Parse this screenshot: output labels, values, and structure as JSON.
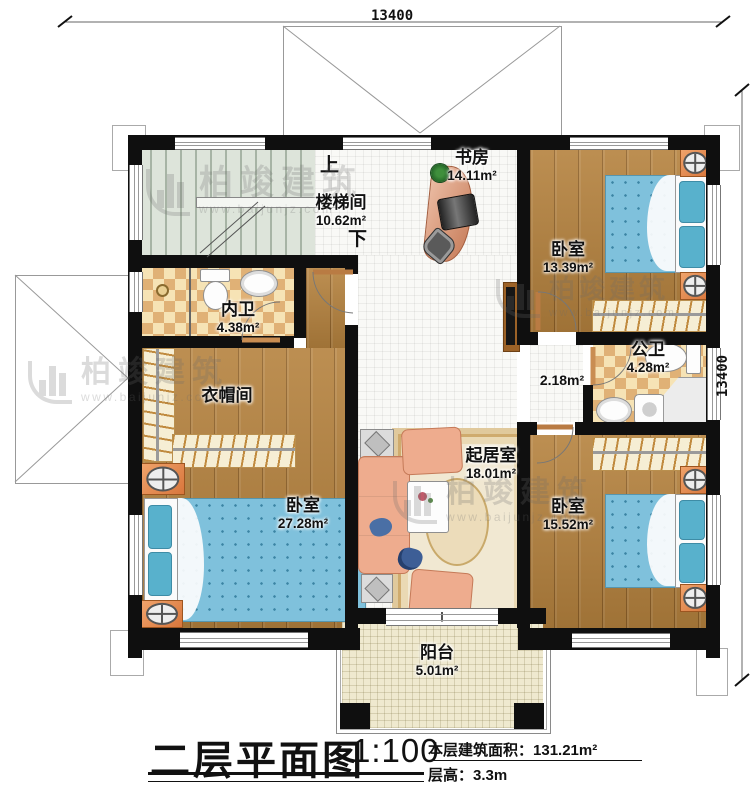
{
  "title_block": {
    "plan_title": "二层平面图",
    "scale": "1:100",
    "area_label": "本层建筑面积：",
    "area_value": "131.21m²",
    "height_label": "层高：",
    "height_value": "3.3m"
  },
  "dimensions": {
    "top": "13400",
    "right": "13400"
  },
  "stairs": {
    "up": "上",
    "down": "下"
  },
  "rooms": [
    {
      "name": "楼梯间",
      "area": "10.62m²"
    },
    {
      "name": "书房",
      "area": "14.11m²"
    },
    {
      "name": "卧室",
      "area": "13.39m²"
    },
    {
      "name": "内卫",
      "area": "4.38m²"
    },
    {
      "name": "衣帽间",
      "area": ""
    },
    {
      "name": "卧室",
      "area": "27.28m²"
    },
    {
      "name": "",
      "area": "2.18m²"
    },
    {
      "name": "公卫",
      "area": "4.28m²"
    },
    {
      "name": "起居室",
      "area": "18.01m²"
    },
    {
      "name": "卧室",
      "area": "15.52m²"
    },
    {
      "name": "阳台",
      "area": "5.01m²"
    }
  ],
  "watermark": {
    "brand": "柏竣建筑",
    "url": "www.baijunjz.com"
  }
}
